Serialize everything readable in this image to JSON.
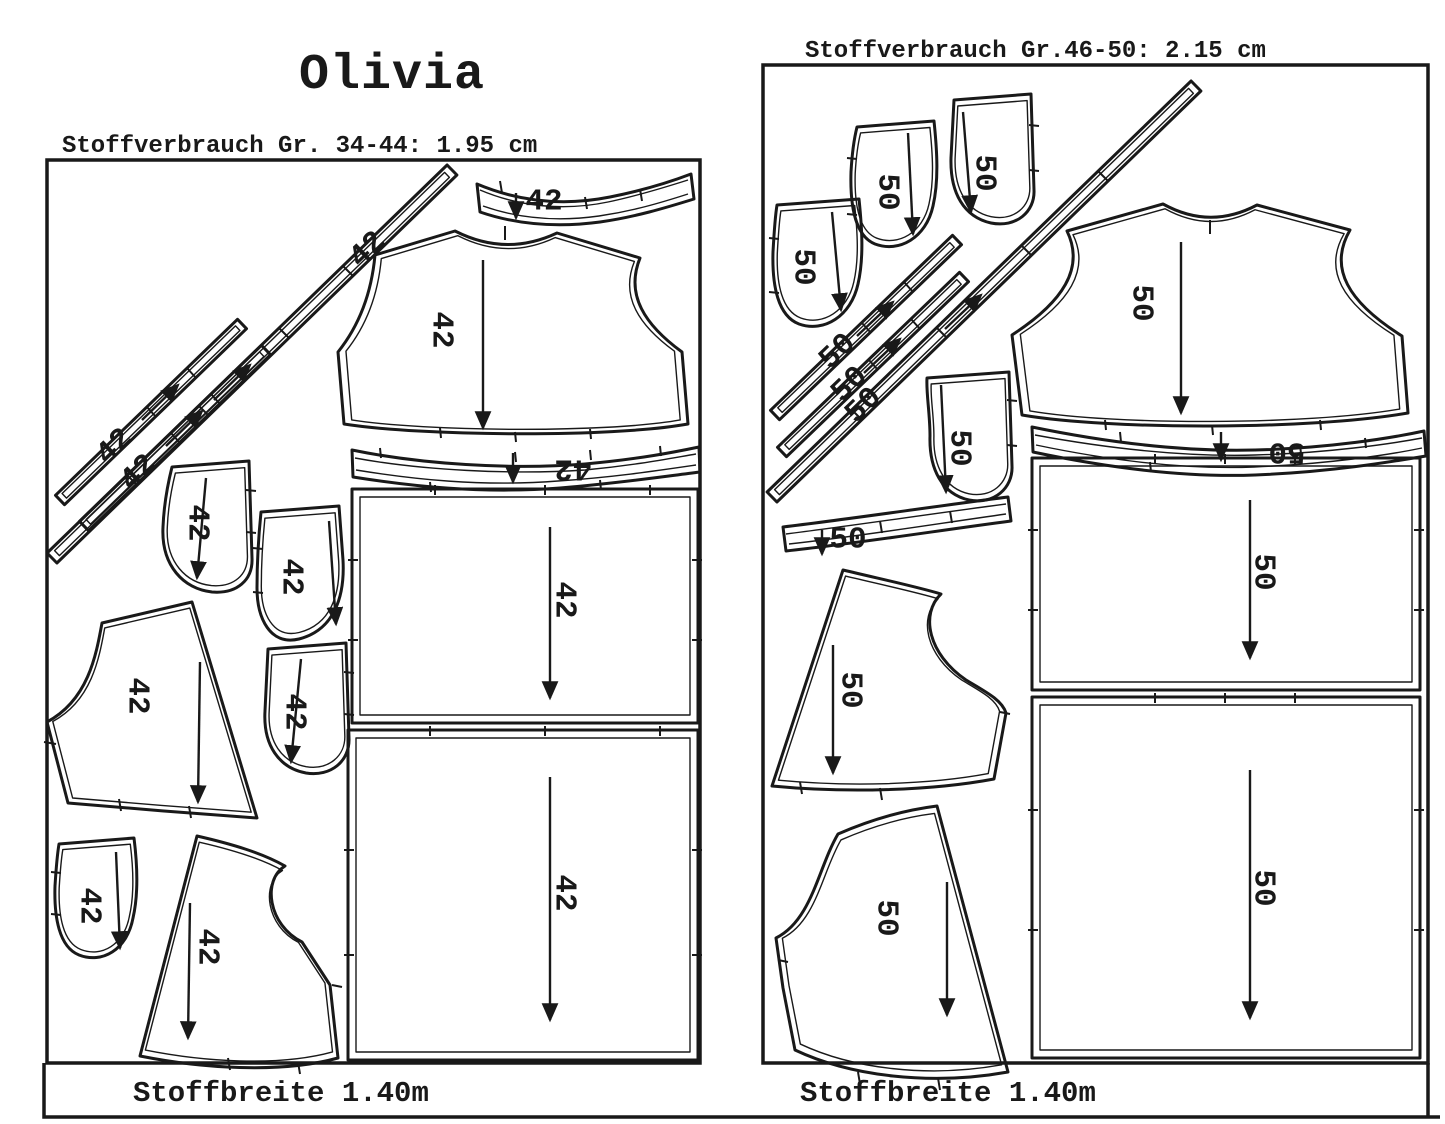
{
  "title": "Olivia",
  "left_panel": {
    "header": "Stoffverbrauch Gr.  34-44: 1.95 cm",
    "footer": "Stoffbreite 1.40m",
    "size_label": "42"
  },
  "right_panel": {
    "header": "Stoffverbrauch Gr.46-50: 2.15 cm",
    "footer": "Stoffbreite 1.40m",
    "size_label": "50"
  },
  "colors": {
    "ink": "#191919",
    "paper": "#ffffff"
  }
}
